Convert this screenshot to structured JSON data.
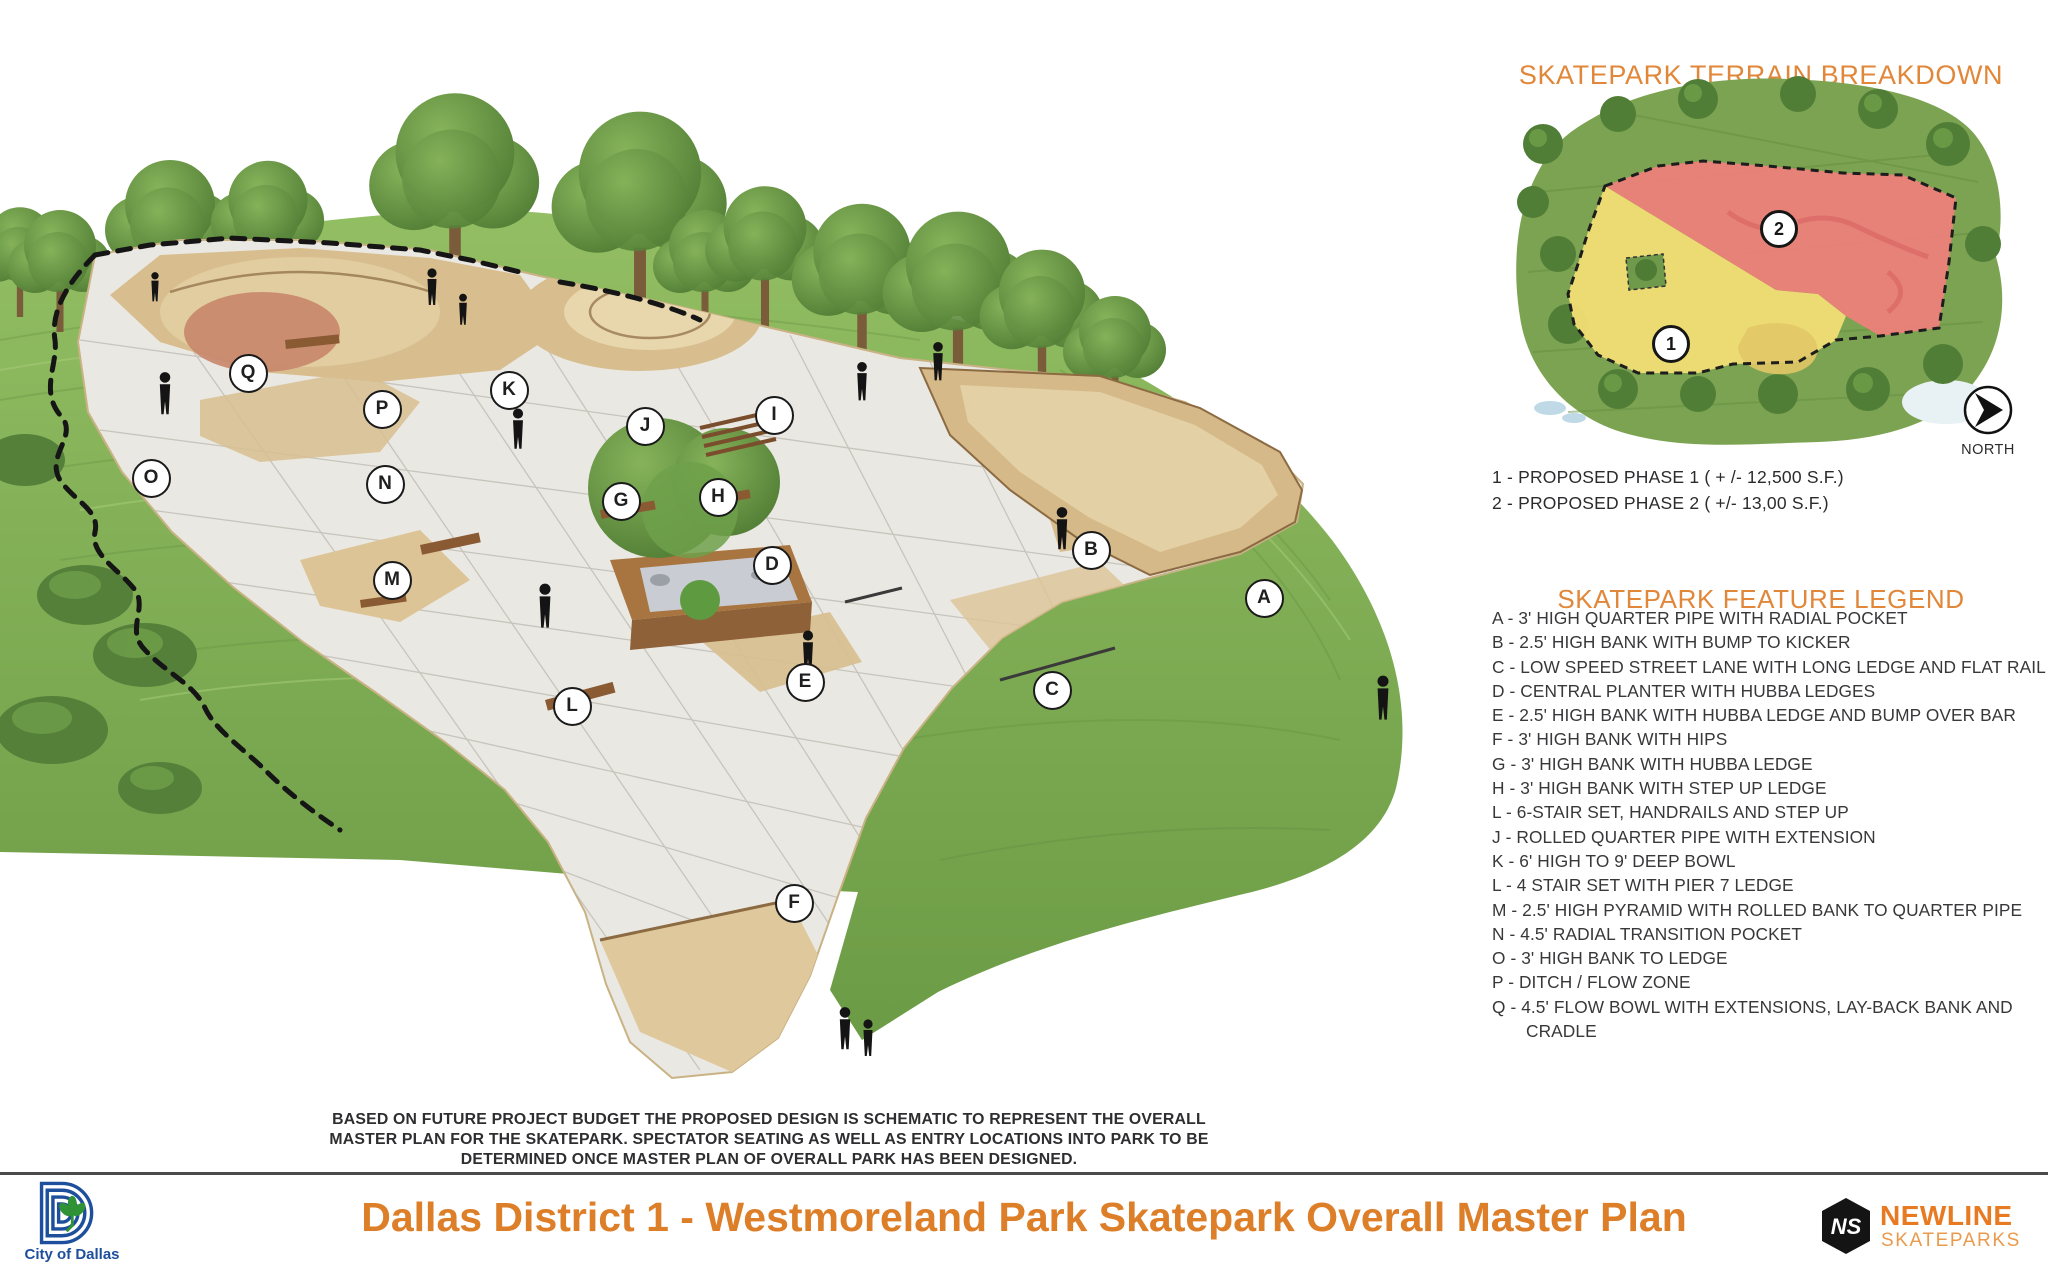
{
  "terrain_panel": {
    "title": "SKATEPARK TERRAIN BREAKDOWN",
    "north_label": "NORTH",
    "phase_notes": [
      "1 - PROPOSED PHASE 1 ( + /- 12,500 S.F.)",
      "2 - PROPOSED PHASE 2 ( +/- 13,00 S.F.)"
    ],
    "map_markers": [
      {
        "label": "1",
        "x": 1668,
        "y": 341
      },
      {
        "label": "2",
        "x": 1776,
        "y": 226
      }
    ]
  },
  "legend": {
    "title": "SKATEPARK FEATURE LEGEND",
    "items": [
      "A - 3' HIGH QUARTER PIPE WITH RADIAL POCKET",
      "B - 2.5' HIGH BANK WITH BUMP TO KICKER",
      "C - LOW SPEED STREET LANE WITH LONG LEDGE AND FLAT RAIL",
      "D - CENTRAL PLANTER WITH HUBBA LEDGES",
      "E - 2.5' HIGH BANK WITH HUBBA LEDGE AND BUMP OVER BAR",
      "F - 3' HIGH BANK WITH HIPS",
      "G - 3'  HIGH BANK WITH HUBBA LEDGE",
      "H - 3' HIGH BANK WITH STEP UP LEDGE",
      "L - 6-STAIR SET, HANDRAILS AND STEP UP",
      "J - ROLLED QUARTER PIPE WITH EXTENSION",
      "K - 6' HIGH TO 9' DEEP BOWL",
      "L - 4 STAIR SET WITH PIER 7 LEDGE",
      "M - 2.5' HIGH PYRAMID WITH ROLLED BANK TO QUARTER PIPE",
      "N - 4.5' RADIAL TRANSITION POCKET",
      "O - 3' HIGH BANK TO LEDGE",
      "P - DITCH / FLOW ZONE",
      "Q - 4.5' FLOW BOWL WITH EXTENSIONS, LAY-BACK BANK AND CRADLE"
    ]
  },
  "rendering_labels": [
    {
      "letter": "Q",
      "x": 246,
      "y": 371
    },
    {
      "letter": "P",
      "x": 380,
      "y": 407
    },
    {
      "letter": "K",
      "x": 507,
      "y": 388
    },
    {
      "letter": "O",
      "x": 149,
      "y": 476
    },
    {
      "letter": "N",
      "x": 383,
      "y": 482
    },
    {
      "letter": "M",
      "x": 390,
      "y": 578
    },
    {
      "letter": "J",
      "x": 643,
      "y": 424
    },
    {
      "letter": "I",
      "x": 772,
      "y": 413
    },
    {
      "letter": "G",
      "x": 619,
      "y": 499
    },
    {
      "letter": "H",
      "x": 716,
      "y": 495
    },
    {
      "letter": "D",
      "x": 770,
      "y": 563
    },
    {
      "letter": "B",
      "x": 1089,
      "y": 548
    },
    {
      "letter": "A",
      "x": 1262,
      "y": 596
    },
    {
      "letter": "E",
      "x": 803,
      "y": 680
    },
    {
      "letter": "C",
      "x": 1050,
      "y": 688
    },
    {
      "letter": "L",
      "x": 570,
      "y": 704
    },
    {
      "letter": "F",
      "x": 792,
      "y": 901
    }
  ],
  "disclaimer": {
    "lines": [
      "BASED ON FUTURE PROJECT BUDGET THE PROPOSED DESIGN IS SCHEMATIC TO REPRESENT  THE  OVERALL",
      "MASTER PLAN FOR THE SKATEPARK.  SPECTATOR SEATING AS WELL AS ENTRY LOCATIONS INTO PARK TO BE",
      "DETERMINED ONCE MASTER PLAN OF OVERALL PARK  HAS BEEN DESIGNED."
    ]
  },
  "footer": {
    "title": "Dallas District 1 - Westmoreland Park Skatepark Overall Master Plan",
    "city_logo_caption": "City of Dallas",
    "newline_line1": "NEWLINE",
    "newline_line2": "SKATEPARKS"
  },
  "colors": {
    "accent_orange": "#E1873A",
    "footer_title_orange": "#DD7E28",
    "text_dark": "#38383a",
    "phase1_yellow": "#F1DE74",
    "phase2_red": "#EF7F7B",
    "dallas_blue": "#1D4F9C",
    "newline_orange": "#E87A22"
  }
}
